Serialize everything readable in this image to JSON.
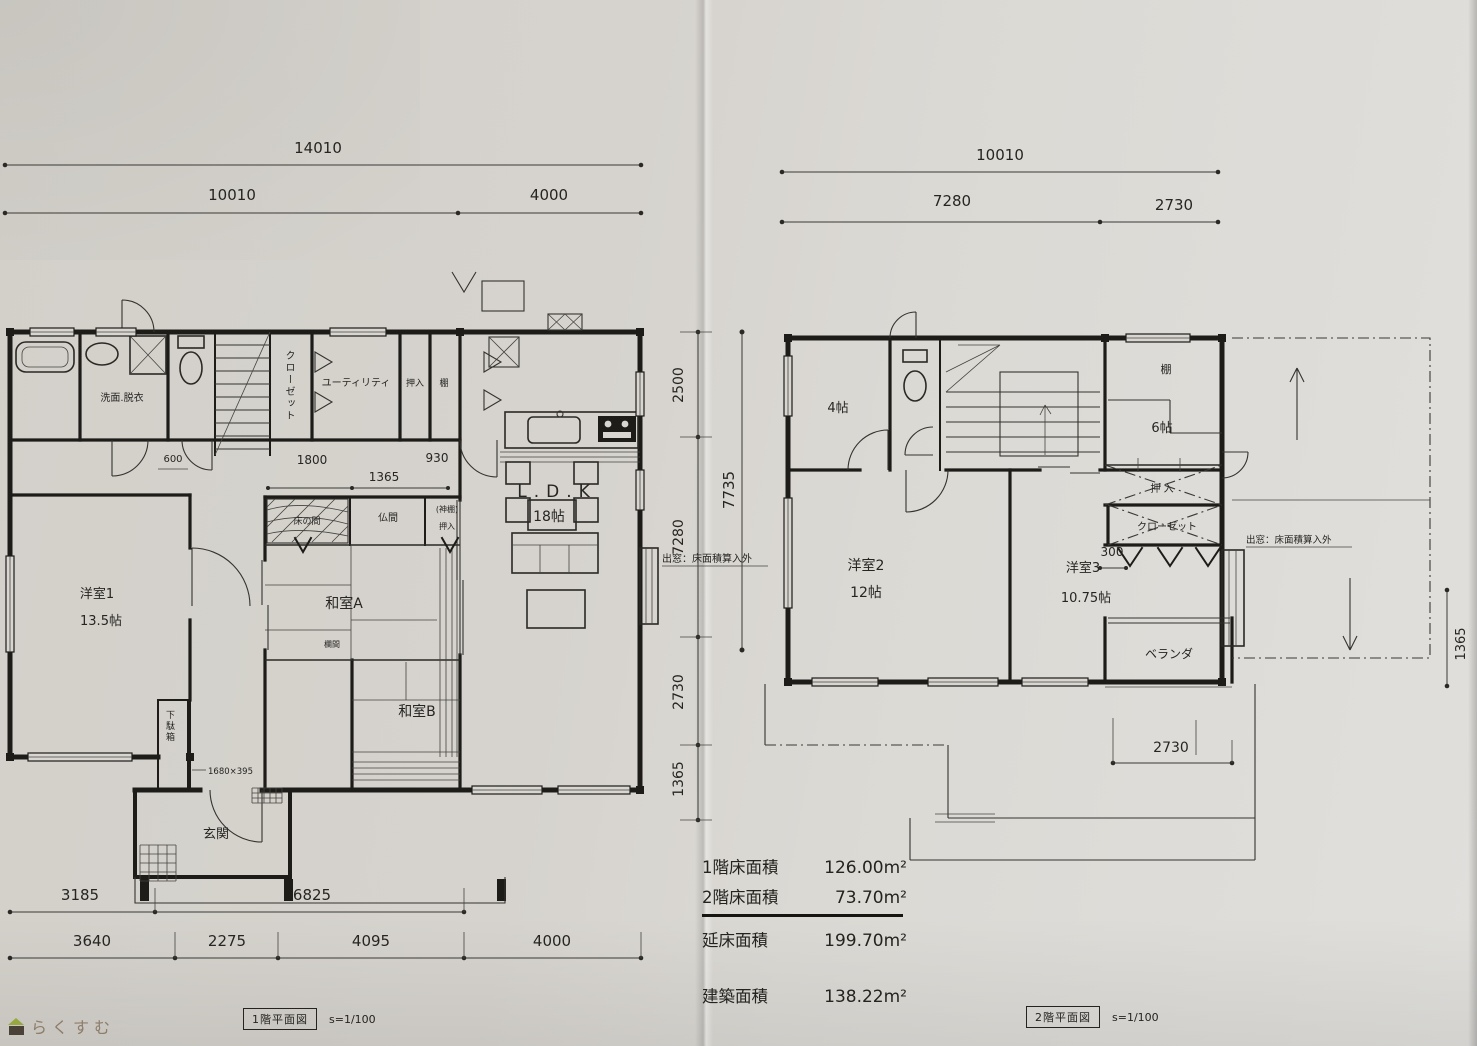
{
  "f1": {
    "tag": "1階平面図",
    "scale": "s=1/100",
    "dims": {
      "top_total": "14010",
      "top_left": "10010",
      "top_right": "4000",
      "in_600": "600",
      "in_1800": "1800",
      "in_930": "930",
      "in_1365": "1365",
      "right_2500": "2500",
      "right_7280": "7280",
      "right_2730": "2730",
      "right_1365": "1365",
      "right_total": "7735",
      "bottom1_left": "3185",
      "bottom1_right": "6825",
      "bottom2_a": "3640",
      "bottom2_b": "2275",
      "bottom2_c": "4095",
      "bottom2_d": "4000",
      "getabako_size": "1680×395"
    },
    "rooms": {
      "senmen": "洗面.脱衣",
      "closet": "クローゼット",
      "utility": "ユーティリティ",
      "oshiire": "押入",
      "tana": "棚",
      "ldk_name": "L.D.K",
      "ldk_size": "18帖",
      "yoshitsu1_name": "洋室1",
      "yoshitsu1_size": "13.5帖",
      "tokonoma": "床の間",
      "butsuma": "仏間",
      "kamidana": "(神棚)",
      "kamidana_oshiire": "押入",
      "washitsu_a": "和室A",
      "ranma": "欄間",
      "washitsu_b": "和室B",
      "getabako": "下駄箱",
      "genkan": "玄関"
    },
    "bay_note": "出窓：床面積算入外"
  },
  "f2": {
    "tag": "2階平面図",
    "scale": "s=1/100",
    "dims": {
      "top_total": "10010",
      "top_left": "7280",
      "top_right": "2730",
      "d300": "300",
      "d2730": "2730",
      "d1365": "1365"
    },
    "rooms": {
      "yojou": "4帖",
      "tana": "棚",
      "rokujou": "6帖",
      "oshiire": "押 入",
      "closet": "クローゼット",
      "yoshitsu2_name": "洋室2",
      "yoshitsu2_size": "12帖",
      "yoshitsu3_name": "洋室3",
      "yoshitsu3_size": "10.75帖",
      "veranda": "ベランダ"
    },
    "bay_note": "出窓：床面積算入外"
  },
  "areas": {
    "rows": [
      {
        "label": "1階床面積",
        "value": "126.00m²"
      },
      {
        "label": "2階床面積",
        "value": "73.70m²"
      },
      {
        "label": "延床面積",
        "value": "199.70m²"
      },
      {
        "label": "建築面積",
        "value": "138.22m²"
      }
    ]
  },
  "watermark": "らくすむ"
}
